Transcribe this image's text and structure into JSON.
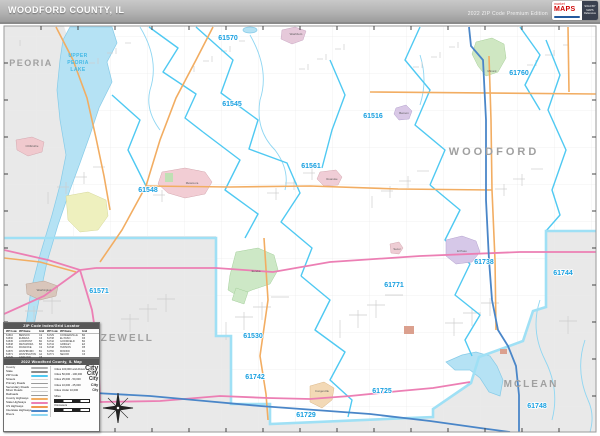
{
  "header": {
    "title": "WOODFORD COUNTY, IL",
    "edition": "2022 ZIP Code Premium Edition",
    "logo": {
      "market": "market",
      "brand": "MAPS",
      "lines": [
        "SOLD BY",
        "MAPS",
        "Reference"
      ]
    }
  },
  "map": {
    "colors": {
      "zip_boundary": "#4fc9f2",
      "county_fill": "#e9e9e9",
      "water": "#b5e2f4",
      "road_county": "#f2ad62",
      "road_state": "#ec7fb4",
      "road_interstate": "#4a86c8",
      "zip_label": "#179fe0"
    },
    "county_labels": [
      {
        "text": "PEORIA",
        "x": 31,
        "y": 66,
        "size": 9,
        "ls": 1.5
      },
      {
        "text": "WOODFORD",
        "x": 494,
        "y": 155,
        "size": 11,
        "ls": 3
      },
      {
        "text": "TAZEWELL",
        "x": 119,
        "y": 341,
        "size": 10,
        "ls": 2
      },
      {
        "text": "MCLEAN",
        "x": 531,
        "y": 387,
        "size": 10,
        "ls": 2
      }
    ],
    "lake_label": {
      "lines": [
        "UPPER",
        "PEORIA",
        "LAKE"
      ],
      "x": 78,
      "y": 57,
      "line_height": 7
    },
    "zip_labels": [
      {
        "text": "61570",
        "x": 228,
        "y": 40
      },
      {
        "text": "61545",
        "x": 232,
        "y": 106
      },
      {
        "text": "61516",
        "x": 373,
        "y": 118
      },
      {
        "text": "61561",
        "x": 311,
        "y": 168
      },
      {
        "text": "61548",
        "x": 148,
        "y": 192
      },
      {
        "text": "61760",
        "x": 519,
        "y": 75
      },
      {
        "text": "61744",
        "x": 563,
        "y": 275
      },
      {
        "text": "61771",
        "x": 394,
        "y": 287
      },
      {
        "text": "61530",
        "x": 253,
        "y": 338
      },
      {
        "text": "61571",
        "x": 99,
        "y": 293
      },
      {
        "text": "61738",
        "x": 484,
        "y": 264
      },
      {
        "text": "61742",
        "x": 255,
        "y": 379
      },
      {
        "text": "61725",
        "x": 382,
        "y": 393
      },
      {
        "text": "61729",
        "x": 306,
        "y": 417
      },
      {
        "text": "61748",
        "x": 537,
        "y": 408
      }
    ],
    "city_labels": [
      {
        "text": "Washburn",
        "x": 296,
        "y": 35
      },
      {
        "text": "Minonk",
        "x": 492,
        "y": 72
      },
      {
        "text": "Chillicothe",
        "x": 32,
        "y": 147
      },
      {
        "text": "Metamora",
        "x": 192,
        "y": 184
      },
      {
        "text": "Benson",
        "x": 404,
        "y": 114
      },
      {
        "text": "Roanoke",
        "x": 332,
        "y": 180
      },
      {
        "text": "Eureka",
        "x": 256,
        "y": 272
      },
      {
        "text": "Secor",
        "x": 397,
        "y": 250
      },
      {
        "text": "El Paso",
        "x": 462,
        "y": 252
      },
      {
        "text": "Congerville",
        "x": 322,
        "y": 392
      },
      {
        "text": "Washington",
        "x": 44,
        "y": 291
      }
    ]
  },
  "index_panel": {
    "title": "ZIP Code Index/Grid Locator",
    "columns": [
      "ZIP Code",
      "ZIP Name",
      "Grid",
      "ZIP Code",
      "ZIP Name",
      "Grid"
    ],
    "rows": [
      [
        "61516",
        "BENSON",
        "C2",
        "61729",
        "CONGERVILLE",
        "B4"
      ],
      [
        "61530",
        "EUREKA",
        "C3",
        "61738",
        "EL PASO",
        "D3"
      ],
      [
        "61545",
        "LOWPOINT",
        "B2",
        "61742",
        "GOODFIELD",
        "B4"
      ],
      [
        "61548",
        "METAMORA",
        "B3",
        "61744",
        "GRIDLEY",
        "E3"
      ],
      [
        "61561",
        "ROANOKE",
        "C2",
        "61748",
        "HUDSON",
        "D5"
      ],
      [
        "61570",
        "WASHBURN",
        "B1",
        "61760",
        "MINONK",
        "D1"
      ],
      [
        "61571",
        "WASHINGTON",
        "A4",
        "61771",
        "SECOR",
        "C3"
      ],
      [
        "61725",
        "CARLOCK",
        "C5",
        "",
        "",
        ""
      ]
    ]
  },
  "legend_panel": {
    "title": "2022 Woodford County, IL Map",
    "items": [
      {
        "label": "County",
        "color": "#b0b0b0"
      },
      {
        "label": "State",
        "color": "#8a8a8a"
      },
      {
        "label": "ZIP Code",
        "color": "#4fc9f2"
      },
      {
        "label": "Streets",
        "color": "#d8d8d8"
      },
      {
        "label": "Primary Roads",
        "color": "#9a9a9a"
      },
      {
        "label": "Secondary Roads",
        "color": "#b5b5b5"
      },
      {
        "label": "Minor Roads",
        "color": "#cccccc"
      },
      {
        "label": "Railroads",
        "color": "#999999"
      },
      {
        "label": "County Highways",
        "color": "#f2ad62"
      },
      {
        "label": "State Highways",
        "color": "#ec7fb4"
      },
      {
        "label": "US Highways",
        "color": "#f0974f"
      },
      {
        "label": "Interstate Highways",
        "color": "#4a86c8"
      },
      {
        "label": "Rivers",
        "color": "#8fd6f2"
      }
    ],
    "city_categories": [
      {
        "label": "Cities 100,000 and Above",
        "size": 7
      },
      {
        "label": "Cities 50,000 - 100,000",
        "size": 6
      },
      {
        "label": "Cities 25,000 - 50,000",
        "size": 5
      },
      {
        "label": "Cities 10,000 - 25,000",
        "size": 4
      },
      {
        "label": "Cities Under 10,000",
        "size": 3.2
      }
    ],
    "city_sample": "City",
    "scale": {
      "miles_label": "Miles",
      "km_label": "Kilometers"
    }
  }
}
